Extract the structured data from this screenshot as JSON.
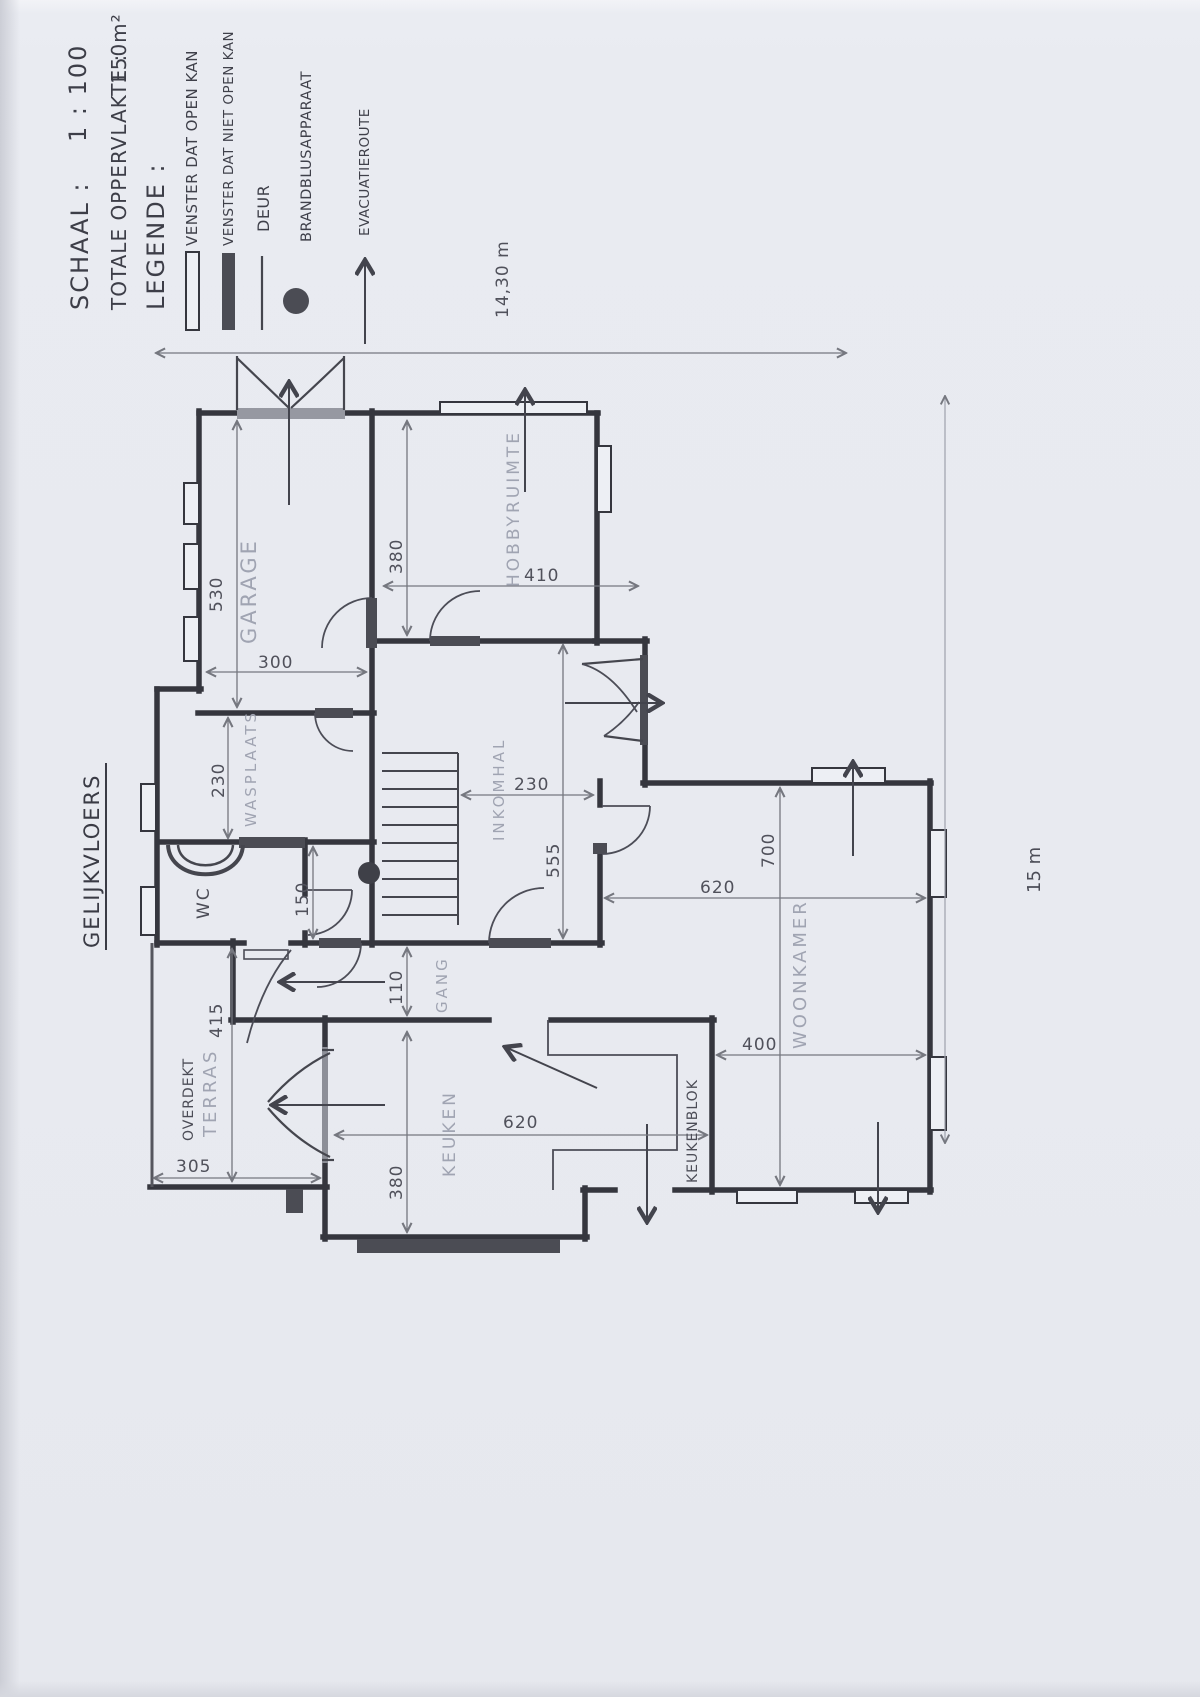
{
  "document": {
    "floor_label": "GELIJKVLOERS",
    "scale_label": "SCHAAL :",
    "scale_value": "1 : 100",
    "area_label": "TOTALE OPPERVLAKTE :",
    "area_value": "150m²",
    "legend_title": "LEGENDE :"
  },
  "legend": {
    "items": [
      {
        "symbol": "open-window",
        "label": "VENSTER DAT OPEN KAN"
      },
      {
        "symbol": "fixed-window",
        "label": "VENSTER DAT NIET OPEN KAN"
      },
      {
        "symbol": "door",
        "label": "DEUR"
      },
      {
        "symbol": "fire-extinguisher",
        "label": "BRANDBLUSAPPARAAT"
      },
      {
        "symbol": "evacuation-route",
        "label": "EVACUATIEROUTE"
      }
    ]
  },
  "rooms": {
    "garage": "GARAGE",
    "hobbyruimte": "HOBBYRUIMTE",
    "wasplaats": "WASPLAATS",
    "wc": "WC",
    "inkomhal": "INKOMHAL",
    "gang": "GANG",
    "keuken": "KEUKEN",
    "keukenblok": "KEUKENBLOK",
    "woonkamer": "WOONKAMER",
    "terras_line1": "OVERDEKT",
    "terras_line2": "TERRAS"
  },
  "dimensions": {
    "overall_width": "14,30 m",
    "overall_height": "15 m",
    "garage_height": "530",
    "garage_width": "300",
    "hobbyruimte_height": "380",
    "hobbyruimte_width": "410",
    "wasplaats_height": "230",
    "hal_height": "150",
    "inkomhal_width": "230",
    "inkomhal_height": "555",
    "gang_width": "110",
    "woonkamer_width": "620",
    "woonkamer_height": "700",
    "woonkamer_right_width": "400",
    "keuken_width": "620",
    "keuken_height": "380",
    "terras_height": "415",
    "terras_width": "305"
  }
}
